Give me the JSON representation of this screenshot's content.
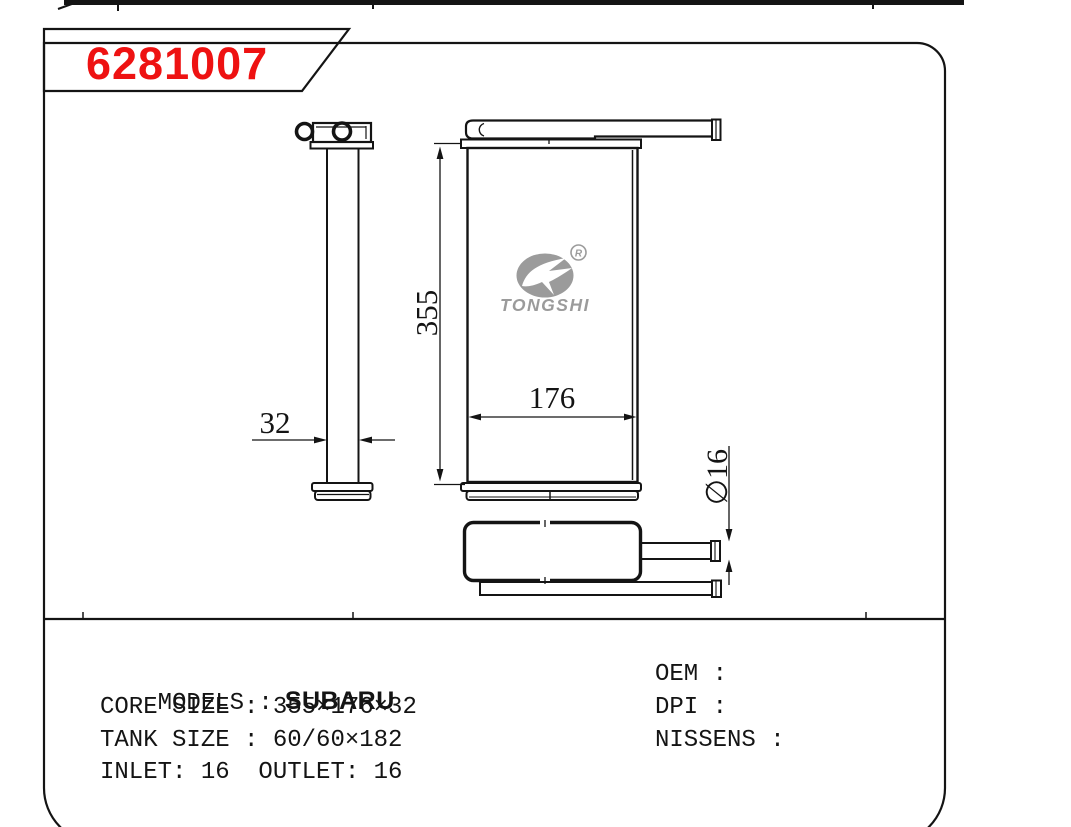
{
  "title": {
    "part_number": "6281007"
  },
  "colors": {
    "part_number_red": "#ee1212",
    "line_black": "#141414",
    "logo_gray": "#9b9b9b"
  },
  "drawing": {
    "dims": {
      "core_height": "355",
      "core_width": "176",
      "core_depth": "32",
      "pipe_diameter": "∅16"
    },
    "logo": {
      "brand": "TONGSHI",
      "registered_mark": "R",
      "icon": "tongshi-bird-logo"
    }
  },
  "specs": {
    "models_label": "MODELS :",
    "models_value": "SUBARU",
    "core_size": "CORE SIZE : 355×176×32",
    "tank_size": "TANK SIZE : 60/60×182",
    "inlet_outlet": "INLET: 16  OUTLET: 16",
    "oem": "OEM :",
    "dpi": "DPI :",
    "nissens": "NISSENS :"
  }
}
